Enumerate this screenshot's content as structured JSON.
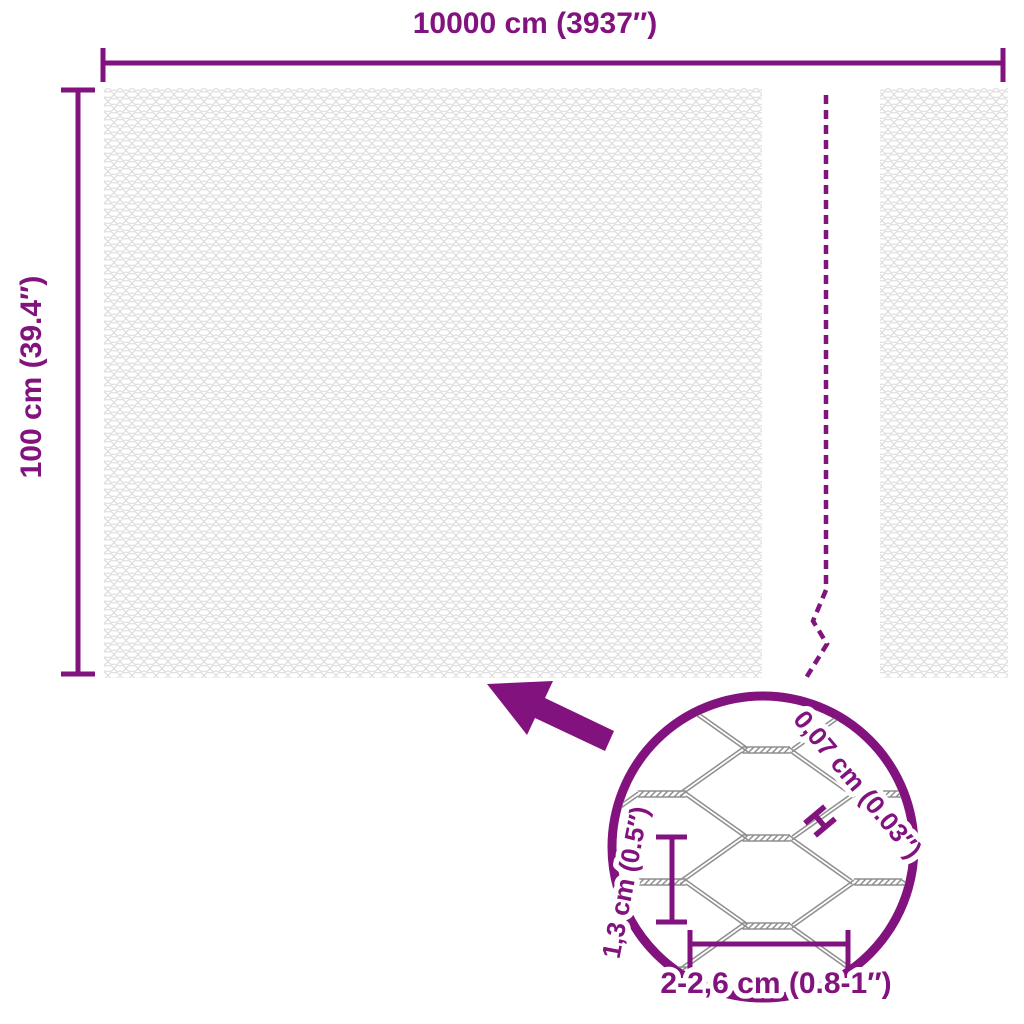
{
  "colors": {
    "accent": "#82137E",
    "mesh_texture": "#D8D8D8",
    "wire": "#8F8F8F",
    "background": "#FFFFFF"
  },
  "main_diagram": {
    "width_label": "10000 cm (3937″)",
    "height_label": "100 cm (39.4″)"
  },
  "detail_view": {
    "wire_thickness_label": "0,07 cm (0.03″)",
    "mesh_height_label": "1,3 cm (0.5″)",
    "mesh_width_label": "2-2,6 cm (0.8-1″)"
  }
}
